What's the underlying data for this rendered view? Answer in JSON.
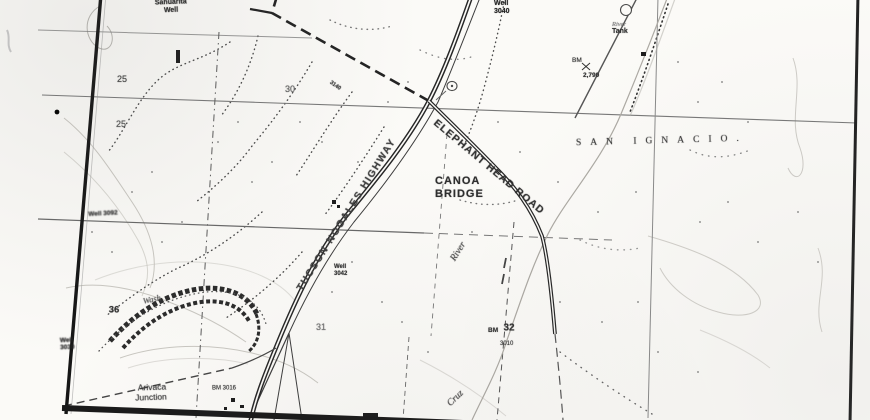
{
  "meta": {
    "type": "scanned black-and-white USGS topographic map",
    "ink_color": "#2b2b2b",
    "paper_color": "#fbfaf7"
  },
  "roads": {
    "highway": "TUCSON-NOGALES HIGHWAY",
    "elephant_head": "ELEPHANT HEAD ROAD"
  },
  "places": {
    "canoa": [
      "CANOA",
      "BRIDGE"
    ],
    "land_grant": "SAN IGNACIO.",
    "arivaca": [
      "Arivaca",
      "Junction"
    ]
  },
  "hydro": {
    "river_word": "River",
    "cruz_word": "Cruz",
    "wash_word": "Wash"
  },
  "sections": {
    "s25a": "25",
    "s25b": "25",
    "s30": "30",
    "s31": "31",
    "s32": "32",
    "s36": "36"
  },
  "spot_features": {
    "sahuarita_well": [
      "Sahuarita",
      "Well"
    ],
    "river_tank": [
      "River",
      "Tank"
    ],
    "well_topright": [
      "Well",
      "3040"
    ],
    "bm_2790": [
      "BM",
      "2,790"
    ],
    "well_3042": [
      "Well",
      "3042"
    ],
    "bm_3010": [
      "BM",
      "3010"
    ],
    "well_3030": [
      "Well",
      "3030"
    ],
    "well_3092": "Well 3092",
    "bm_3016": "BM 3016",
    "spot_3140": "3140"
  }
}
